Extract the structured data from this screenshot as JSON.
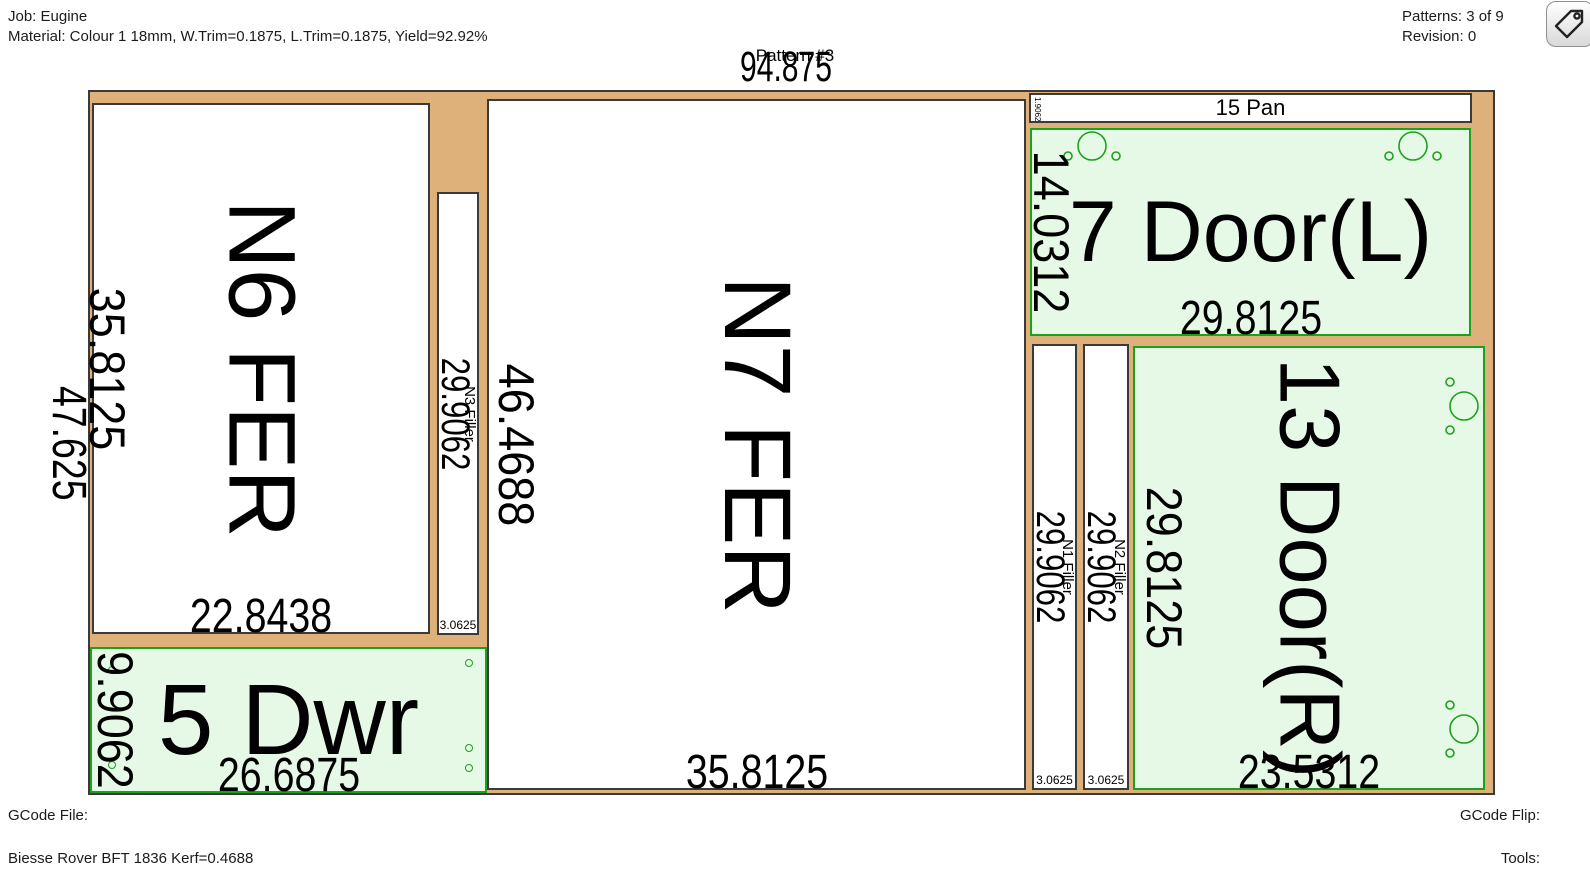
{
  "header": {
    "job": "Job: Eugine",
    "material": "Material: Colour 1 18mm, W.Trim=0.1875, L.Trim=0.1875, Yield=92.92%",
    "patterns": "Patterns: 3 of 9",
    "revision": "Revision: 0"
  },
  "pattern": {
    "title": "Pattern #3",
    "sheet_width_dim": "94.875",
    "sheet_height_dim": "47.625"
  },
  "parts": {
    "n6": {
      "label": "N6 FER",
      "width_dim": "22.8438",
      "height_dim": "35.8125"
    },
    "n3": {
      "label": "N3 Filler",
      "width_dim": "3.0625",
      "height_dim": "29.9062"
    },
    "n7": {
      "label": "N7 FER",
      "width_dim": "35.8125",
      "height_dim": "46.4688"
    },
    "pan15": {
      "label": "15 Pan",
      "width_dim": "29.8125",
      "height_dim": "1.9062"
    },
    "door7": {
      "label": "7 Door(L)",
      "width_dim": "29.8125",
      "height_dim": "14.0312"
    },
    "n1": {
      "label": "N1 Filler",
      "width_dim": "3.0625",
      "height_dim": "29.9062"
    },
    "n2": {
      "label": "N2 Filler",
      "width_dim": "3.0625",
      "height_dim": "29.9062"
    },
    "door13": {
      "label": "13 Door(R)",
      "width_dim": "23.5312",
      "height_dim": "29.8125"
    },
    "dwr5": {
      "label": "5 Dwr",
      "width_dim": "26.6875",
      "height_dim": "9.9062"
    }
  },
  "footer": {
    "gcode_file_label": "GCode File:",
    "machine": "Biesse Rover BFT 1836 Kerf=0.4688",
    "gcode_flip_label": "GCode Flip:",
    "tools_label": "Tools:"
  },
  "icons": {
    "toolbar_button": "tag-icon",
    "hinge_marks": "hinge-bore-icon",
    "drawer_marks": "drill-hole-icon"
  },
  "colors": {
    "sheet_waste": "#DDB179",
    "part_fill": "#FFFFFF",
    "part_border": "#3A3A3A",
    "offcut_fill": "#E6F9E6",
    "offcut_border": "#1CA11C",
    "text": "#000000"
  }
}
